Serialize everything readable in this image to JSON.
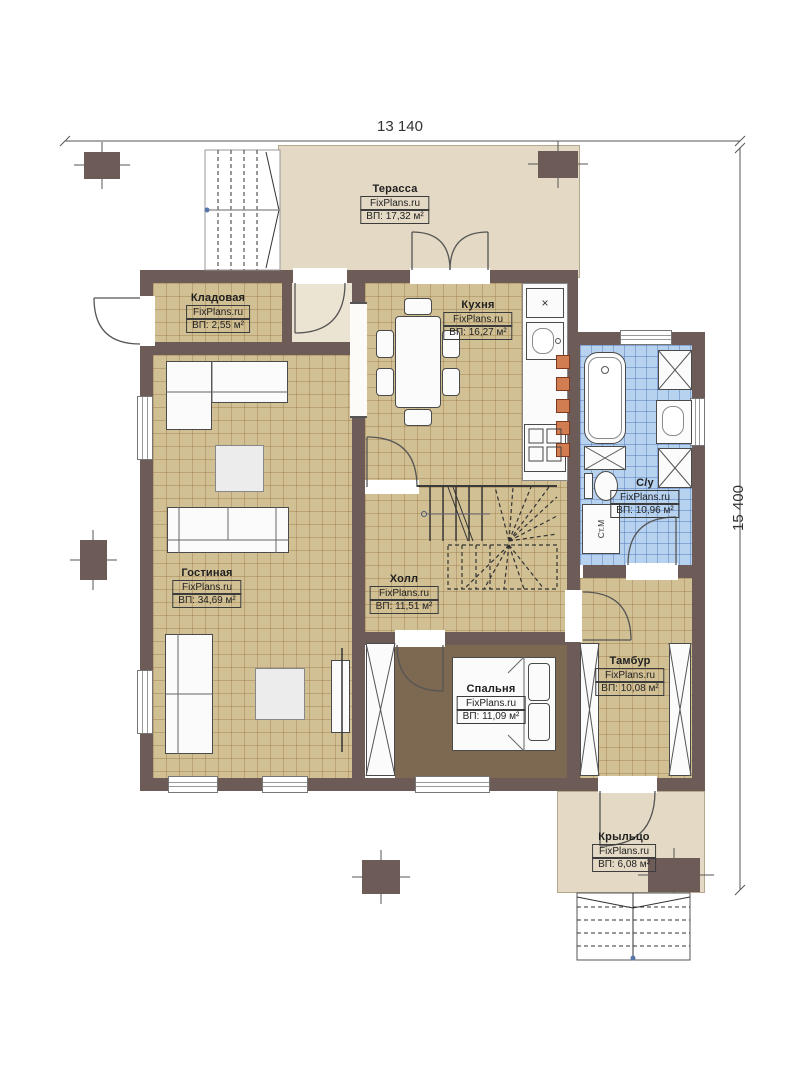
{
  "dimensions": {
    "width_label": "13 140",
    "height_label": "15 400"
  },
  "rooms": [
    {
      "key": "terrace",
      "name": "Терасса",
      "brand": "FixPlans.ru",
      "area": "ВП: 17,32 м²"
    },
    {
      "key": "storage",
      "name": "Кладовая",
      "brand": "FixPlans.ru",
      "area": "ВП: 2,55 м²"
    },
    {
      "key": "kitchen",
      "name": "Кухня",
      "brand": "FixPlans.ru",
      "area": "ВП: 16,27 м²"
    },
    {
      "key": "living",
      "name": "Гостиная",
      "brand": "FixPlans.ru",
      "area": "ВП: 34,69 м²"
    },
    {
      "key": "hall",
      "name": "Холл",
      "brand": "FixPlans.ru",
      "area": "ВП: 11,51 м²"
    },
    {
      "key": "bathroom",
      "name": "С/у",
      "brand": "FixPlans.ru",
      "area": "ВП: 10,96 м²"
    },
    {
      "key": "bedroom",
      "name": "Спальня",
      "brand": "FixPlans.ru",
      "area": "ВП: 11,09 м²"
    },
    {
      "key": "tambour",
      "name": "Тамбур",
      "brand": "FixPlans.ru",
      "area": "ВП: 10,08 м²"
    },
    {
      "key": "porch",
      "name": "Крыльцо",
      "brand": "FixPlans.ru",
      "area": "ВП: 6,08 м²"
    }
  ],
  "annotations": {
    "washing_machine": "Ст.М",
    "vent_symbol": "×"
  },
  "colors": {
    "wall": "#6d5b58",
    "floor_tile": "#d2c095",
    "floor_bedroom": "#7d6951",
    "floor_bath": "#b7d2ef",
    "terrace": "#e3d9c4",
    "flue": "#d27c52"
  }
}
